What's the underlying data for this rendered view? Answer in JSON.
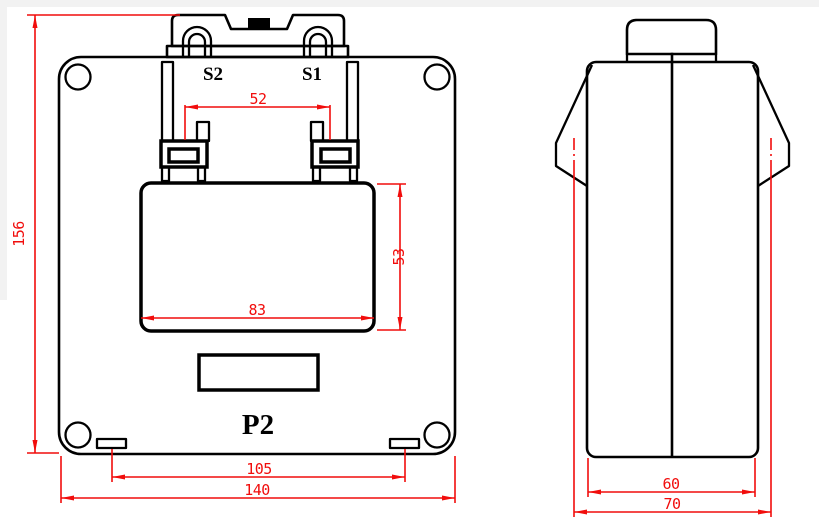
{
  "front_view": {
    "terminal_label_s2": "S2",
    "terminal_label_s1": "S1",
    "polarity_label": "P2",
    "dim_overall_height": "156",
    "dim_terminal_pitch": "52",
    "dim_window_height": "53",
    "dim_window_width": "83",
    "dim_slot_pitch": "105",
    "dim_overall_width": "140"
  },
  "side_view": {
    "dim_body_depth": "60",
    "dim_overall_depth": "70"
  },
  "colors": {
    "dimension_red": "#f10d0c",
    "outline_black": "#000000",
    "background": "#ffffff"
  }
}
